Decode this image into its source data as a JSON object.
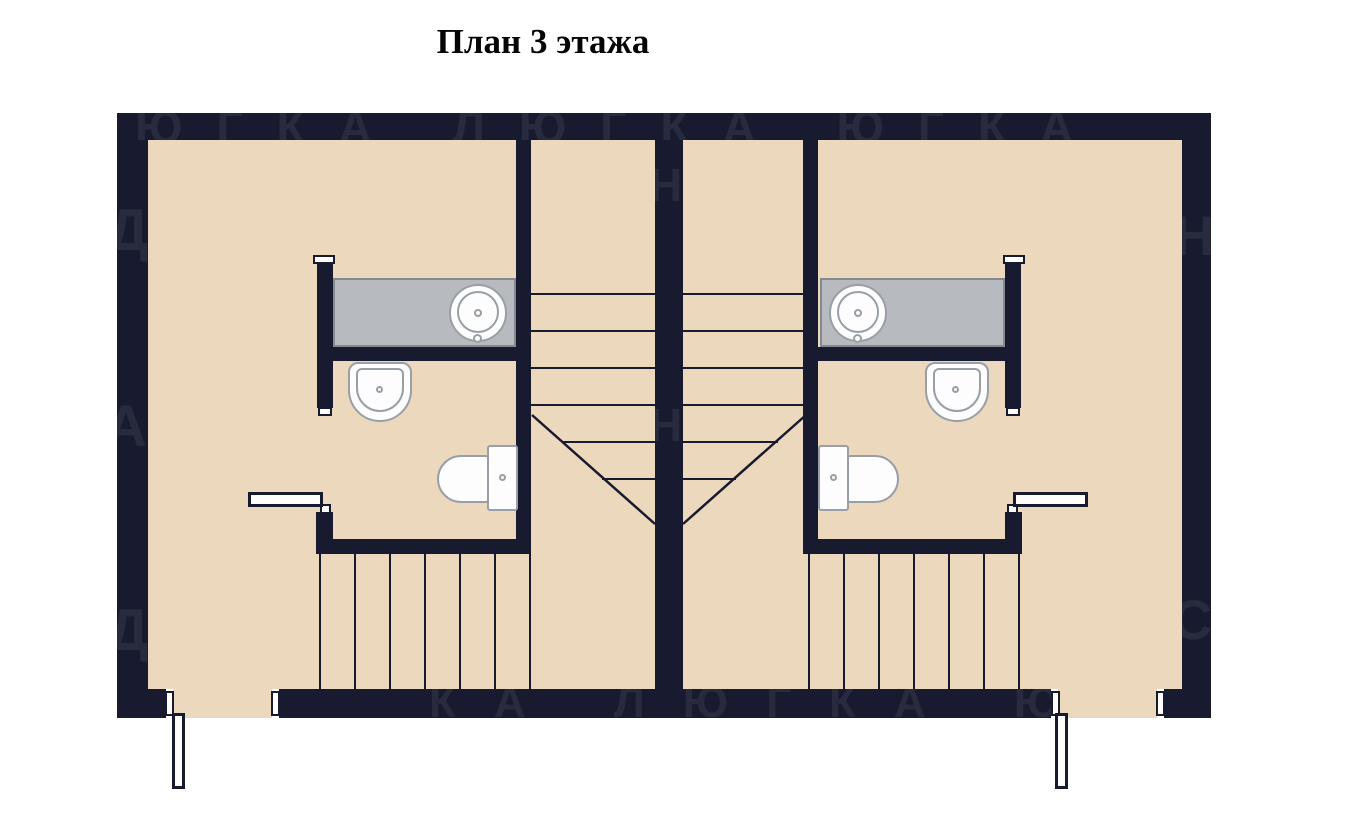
{
  "title": "План 3 этажа",
  "watermark": {
    "top": "ЮГКА ЛЮГКА ЮГКА",
    "bottom": "КА ЛЮГКА ЮГ",
    "left": [
      "Д",
      "А",
      "Д"
    ],
    "center": [
      "НО",
      "НО"
    ],
    "right": [
      "Н",
      "С"
    ]
  },
  "colors": {
    "background": "#ffffff",
    "wall": "#181a30",
    "floor": "#ecd9bd",
    "counter": "#b7bbbf",
    "counter-border": "#85898e",
    "fixture-fill": "#fdfdfd",
    "fixture-border": "#999fa6",
    "stair-line": "#181a30",
    "watermark": "rgba(255,255,255,0.07)",
    "title-color": "#050505"
  }
}
